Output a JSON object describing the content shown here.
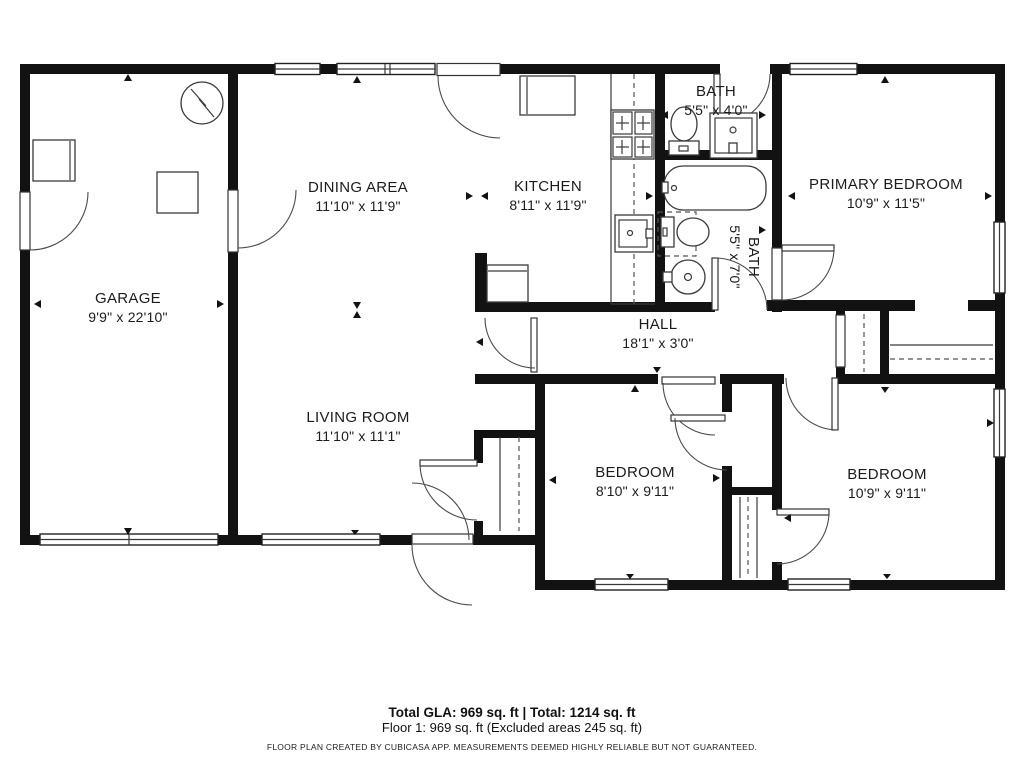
{
  "rooms": {
    "garage": {
      "name": "GARAGE",
      "dims": "9'9\" x 22'10\""
    },
    "dining": {
      "name": "DINING AREA",
      "dims": "11'10\" x 11'9\""
    },
    "kitchen": {
      "name": "KITCHEN",
      "dims": "8'11\" x 11'9\""
    },
    "bath1": {
      "name": "BATH",
      "dims": "5'5\" x 4'0\""
    },
    "bath2": {
      "name": "BATH",
      "dims": "5'5\" x 7'0\""
    },
    "primary": {
      "name": "PRIMARY BEDROOM",
      "dims": "10'9\" x 11'5\""
    },
    "hall": {
      "name": "HALL",
      "dims": "18'1\" x 3'0\""
    },
    "living": {
      "name": "LIVING ROOM",
      "dims": "11'10\" x 11'1\""
    },
    "bedroom1": {
      "name": "BEDROOM",
      "dims": "8'10\" x 9'11\""
    },
    "bedroom2": {
      "name": "BEDROOM",
      "dims": "10'9\" x 9'11\""
    }
  },
  "footer": {
    "totals": "Total GLA: 969 sq. ft | Total: 1214 sq. ft",
    "floor": "Floor 1: 969 sq. ft (Excluded areas 245 sq. ft)",
    "disclaimer": "FLOOR PLAN CREATED BY CUBICASA APP. MEASUREMENTS DEEMED HIGHLY RELIABLE BUT NOT GUARANTEED."
  },
  "colors": {
    "wall": "#121212",
    "background": "#ffffff",
    "line": "#3a3a3a"
  }
}
